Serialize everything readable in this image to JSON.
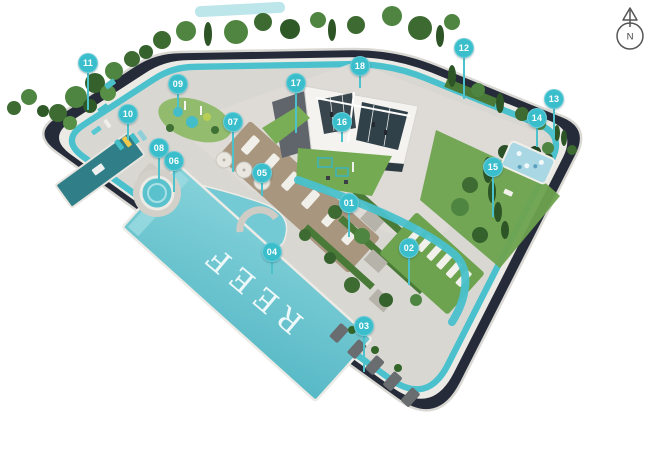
{
  "site": {
    "pool_label": "REEF",
    "accent_color": "#3bbecc",
    "leader_color": "#4cc2cc",
    "track_color": "#4ac1cc",
    "road_color": "#262b3a",
    "deck_color": "#d9d7d2",
    "lawn_color": "#6da34e",
    "pool_color": "#64c2cd"
  },
  "compass": {
    "label": "N"
  },
  "markers": [
    {
      "number": "01",
      "x": 349,
      "y": 203,
      "line_end_y": 237
    },
    {
      "number": "02",
      "x": 409,
      "y": 248,
      "line_end_y": 285
    },
    {
      "number": "03",
      "x": 364,
      "y": 326,
      "line_end_y": 372
    },
    {
      "number": "04",
      "x": 272,
      "y": 252,
      "line_end_y": 274
    },
    {
      "number": "05",
      "x": 262,
      "y": 173,
      "line_end_y": 196
    },
    {
      "number": "06",
      "x": 174,
      "y": 161,
      "line_end_y": 192
    },
    {
      "number": "07",
      "x": 233,
      "y": 122,
      "line_end_y": 172
    },
    {
      "number": "08",
      "x": 159,
      "y": 148,
      "line_end_y": 182
    },
    {
      "number": "09",
      "x": 178,
      "y": 84,
      "line_end_y": 107
    },
    {
      "number": "10",
      "x": 128,
      "y": 114,
      "line_end_y": 140
    },
    {
      "number": "11",
      "x": 88,
      "y": 63,
      "line_end_y": 110
    },
    {
      "number": "12",
      "x": 464,
      "y": 48,
      "line_end_y": 99
    },
    {
      "number": "13",
      "x": 554,
      "y": 99,
      "line_end_y": 138
    },
    {
      "number": "14",
      "x": 537,
      "y": 118,
      "line_end_y": 147
    },
    {
      "number": "15",
      "x": 493,
      "y": 167,
      "line_end_y": 217
    },
    {
      "number": "16",
      "x": 342,
      "y": 122,
      "line_end_y": 142
    },
    {
      "number": "17",
      "x": 296,
      "y": 83,
      "line_end_y": 133
    },
    {
      "number": "18",
      "x": 360,
      "y": 66,
      "line_end_y": 88
    }
  ]
}
